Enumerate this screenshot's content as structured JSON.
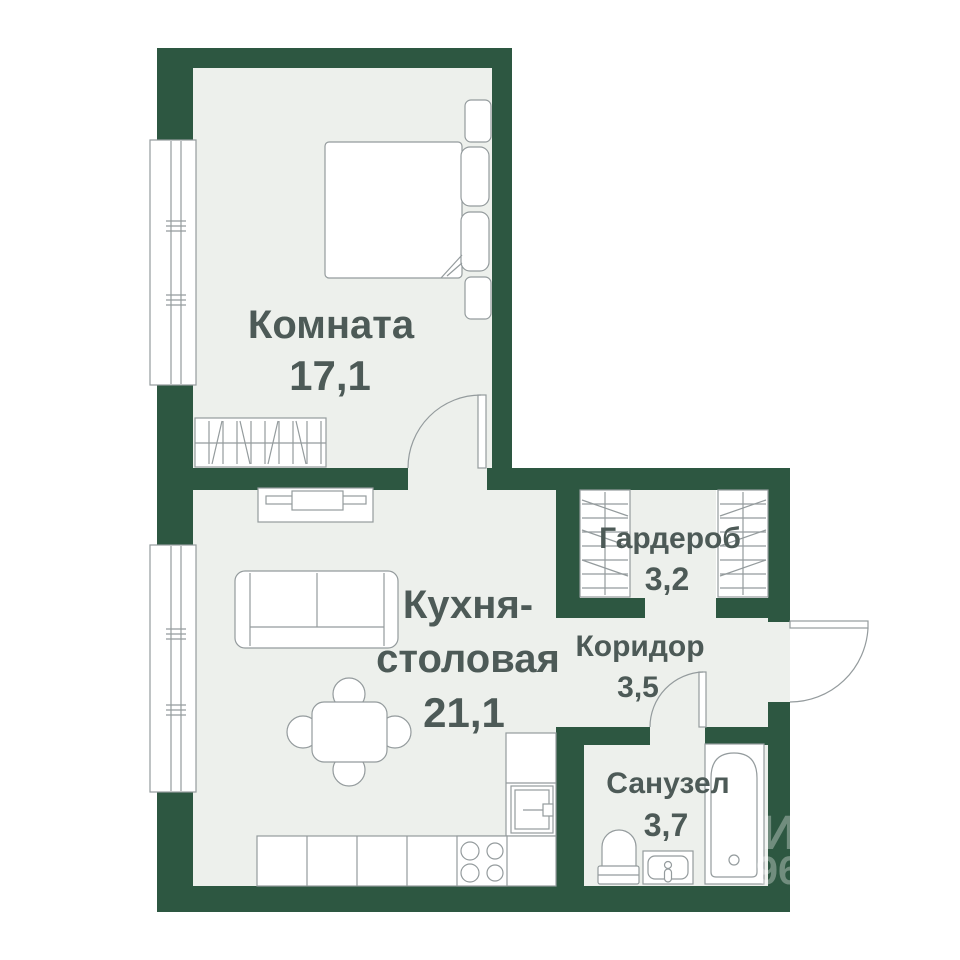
{
  "plan": {
    "colors": {
      "wall": "#2d5741",
      "floor": "#edf0ec",
      "label": "#4d5a57",
      "line": "#949b9d",
      "background": "#ffffff"
    },
    "rooms": [
      {
        "id": "bedroom",
        "name": "Комната",
        "area": "17,1"
      },
      {
        "id": "kitchen",
        "name_line1": "Кухня-",
        "name_line2": "столовая",
        "area": "21,1"
      },
      {
        "id": "wardrobe",
        "name": "Гардероб",
        "area": "3,2"
      },
      {
        "id": "corridor",
        "name": "Коридор",
        "area": "3,5"
      },
      {
        "id": "bathroom",
        "name": "Санузел",
        "area": "3,7"
      }
    ],
    "watermark": {
      "fragment1": "И",
      "fragment2": "96"
    }
  }
}
